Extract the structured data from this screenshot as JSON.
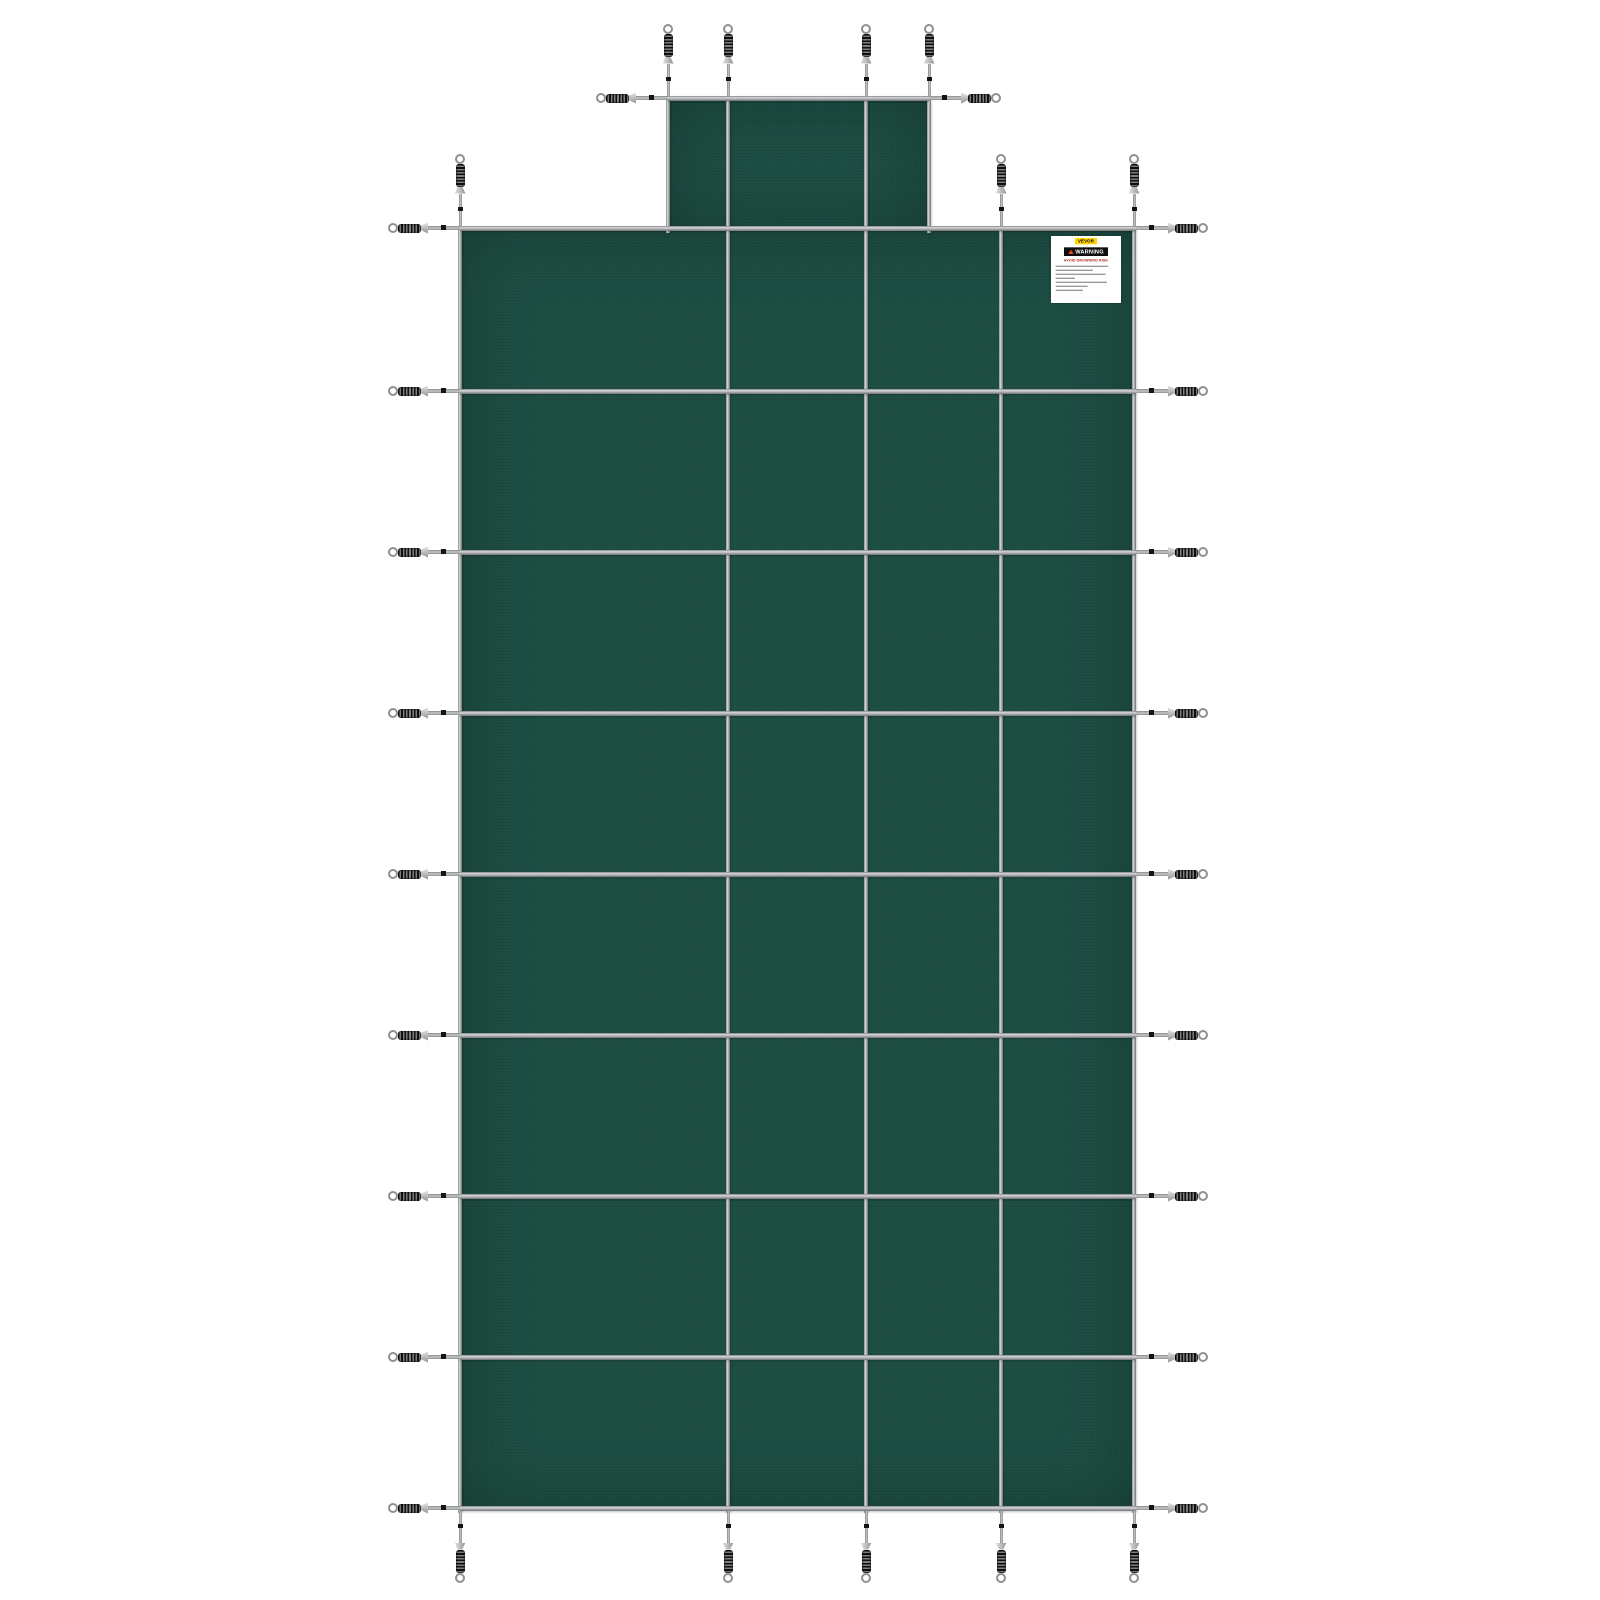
{
  "label": {
    "brand": "VEVOR",
    "warning_word": "WARNING",
    "heading": "AVOID  DROWNING  RISK",
    "fine_print_line_widths": [
      158,
      112,
      150,
      58,
      154,
      96,
      82
    ]
  },
  "colors": {
    "mesh_green": "#1f5046",
    "strap_gray": "#b4b6b8",
    "spring_coil_dark": "#101010",
    "hardware_silver": "#c6c8ca",
    "label_yellow": "#ffd400",
    "warning_bar_black": "#0e0e0e",
    "warning_triangle_red": "#e8481c",
    "heading_red": "#b3261e",
    "background": "#ffffff"
  },
  "geometry": {
    "main_panel": {
      "x": 460,
      "y": 228,
      "w": 676,
      "h": 1282
    },
    "step_panel": {
      "x": 668,
      "y": 98,
      "w": 261,
      "h": 134
    },
    "v_straps": [
      {
        "x": 460,
        "y1": 228,
        "y2": 1508
      },
      {
        "x": 728,
        "y1": 98,
        "y2": 1508
      },
      {
        "x": 866,
        "y1": 98,
        "y2": 1508
      },
      {
        "x": 1001,
        "y1": 228,
        "y2": 1508
      },
      {
        "x": 1134,
        "y1": 228,
        "y2": 1508
      },
      {
        "x": 668,
        "y1": 98,
        "y2": 228
      },
      {
        "x": 929,
        "y1": 98,
        "y2": 228
      }
    ],
    "h_straps": [
      {
        "y": 98,
        "x1": 668,
        "x2": 929
      },
      {
        "y": 228,
        "x1": 460,
        "x2": 1136
      },
      {
        "y": 391,
        "x1": 460,
        "x2": 1136
      },
      {
        "y": 552,
        "x1": 460,
        "x2": 1136
      },
      {
        "y": 713,
        "x1": 460,
        "x2": 1136
      },
      {
        "y": 874,
        "x1": 460,
        "x2": 1136
      },
      {
        "y": 1035,
        "x1": 460,
        "x2": 1136
      },
      {
        "y": 1196,
        "x1": 460,
        "x2": 1136
      },
      {
        "y": 1357,
        "x1": 460,
        "x2": 1136
      },
      {
        "y": 1508,
        "x1": 460,
        "x2": 1136
      }
    ],
    "springs": {
      "up": [
        {
          "x": 668,
          "y": 95.5
        },
        {
          "x": 728,
          "y": 95.5
        },
        {
          "x": 866,
          "y": 95.5
        },
        {
          "x": 929,
          "y": 95.5
        },
        {
          "x": 460,
          "y": 225.5
        },
        {
          "x": 1001,
          "y": 225.5
        },
        {
          "x": 1134,
          "y": 225.5
        }
      ],
      "down": [
        {
          "x": 460,
          "y": 1510.5
        },
        {
          "x": 728,
          "y": 1510.5
        },
        {
          "x": 866,
          "y": 1510.5
        },
        {
          "x": 1001,
          "y": 1510.5
        },
        {
          "x": 1134,
          "y": 1510.5
        }
      ],
      "left": [
        {
          "x": 668,
          "y": 98
        },
        {
          "x": 460,
          "y": 228
        },
        {
          "x": 460,
          "y": 391
        },
        {
          "x": 460,
          "y": 552
        },
        {
          "x": 460,
          "y": 713
        },
        {
          "x": 460,
          "y": 874
        },
        {
          "x": 460,
          "y": 1035
        },
        {
          "x": 460,
          "y": 1196
        },
        {
          "x": 460,
          "y": 1357
        },
        {
          "x": 460,
          "y": 1508
        }
      ],
      "right": [
        {
          "x": 929,
          "y": 98
        },
        {
          "x": 1136,
          "y": 228
        },
        {
          "x": 1136,
          "y": 391
        },
        {
          "x": 1136,
          "y": 552
        },
        {
          "x": 1136,
          "y": 713
        },
        {
          "x": 1136,
          "y": 874
        },
        {
          "x": 1136,
          "y": 1035
        },
        {
          "x": 1136,
          "y": 1196
        },
        {
          "x": 1136,
          "y": 1357
        },
        {
          "x": 1136,
          "y": 1508
        }
      ]
    }
  }
}
